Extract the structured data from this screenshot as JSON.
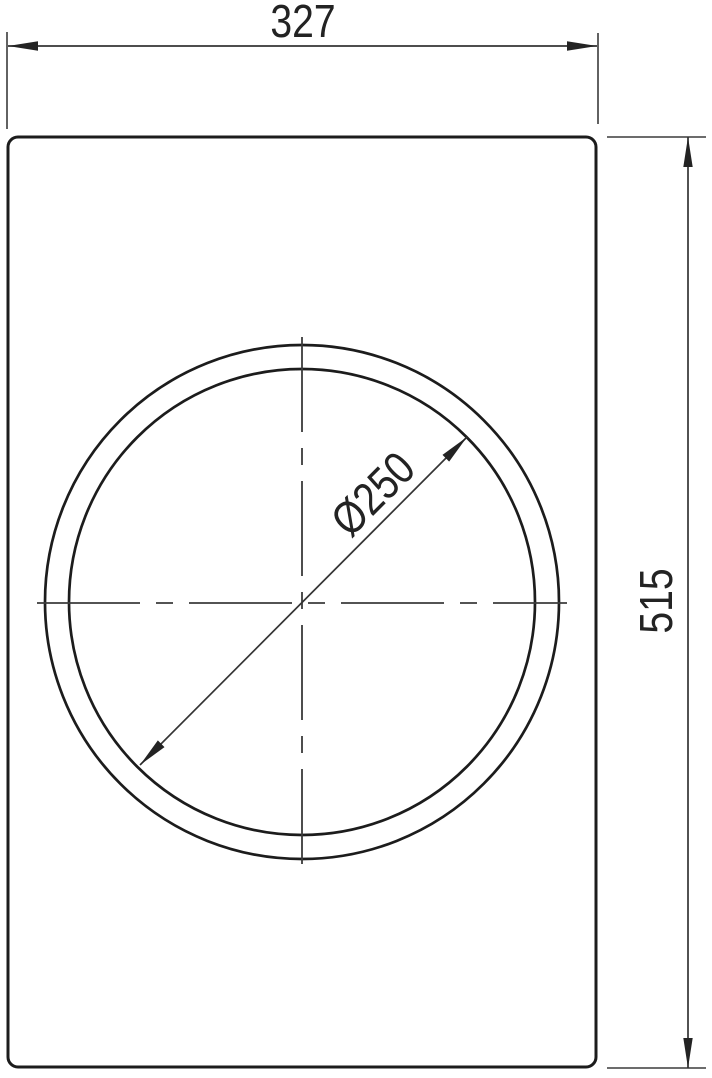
{
  "drawing": {
    "type": "technical-cutout-dimension-drawing",
    "background_color": "#ffffff",
    "line_color": "#1c1c1c",
    "dim_line_color": "#343434",
    "text_color": "#232323",
    "dimensions": {
      "width": {
        "label": "327",
        "orientation": "horizontal-top"
      },
      "height": {
        "label": "515",
        "orientation": "vertical-right"
      },
      "cutout_diameter": {
        "label": "Ø250",
        "orientation": "diagonal-45"
      }
    }
  }
}
